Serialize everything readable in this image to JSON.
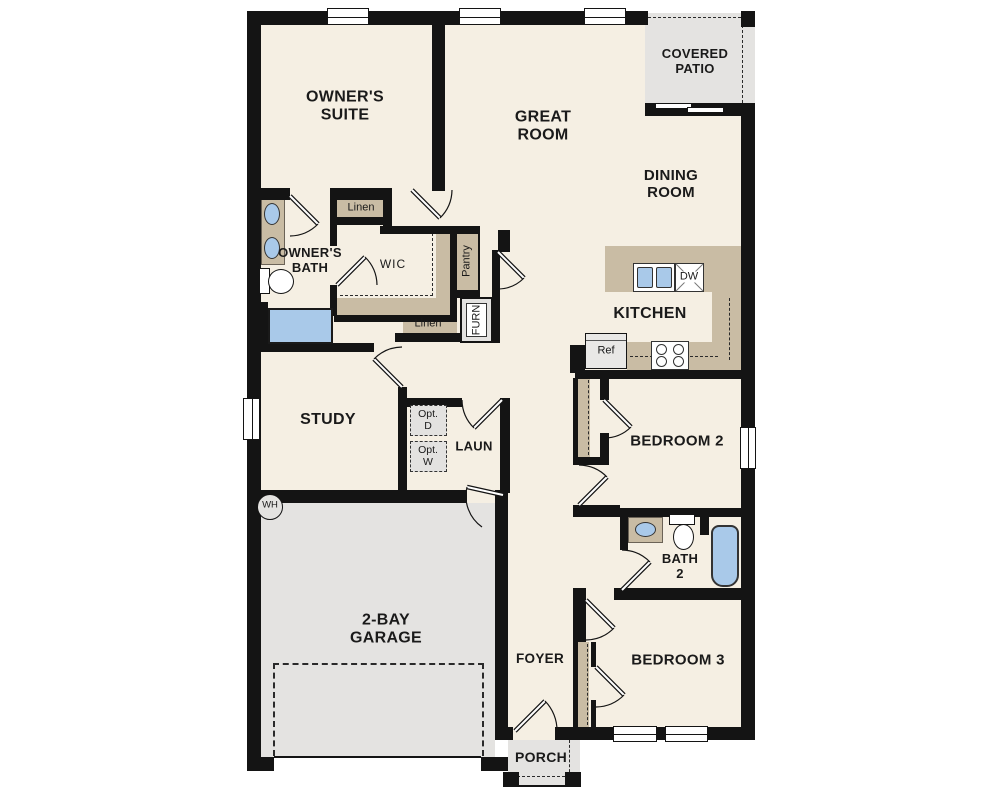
{
  "type": "residential-floor-plan",
  "colors": {
    "floor": "#f5efe3",
    "wall": "#141414",
    "casework_tan": "#c9bca4",
    "concrete_gray": "#e4e3e1",
    "fixture_blue": "#a9c9e9",
    "appliance_gray": "#e9e8e6"
  },
  "labels": {
    "owners_suite": "OWNER'S SUITE",
    "great_room": "GREAT ROOM",
    "covered_patio": "COVERED PATIO",
    "dining_room": "DINING ROOM",
    "owners_bath": "OWNER'S BATH",
    "wic": "WIC",
    "linen_top": "Linen",
    "linen_bottom": "Linen",
    "pantry": "Pantry",
    "furnace": "FURN",
    "kitchen": "KITCHEN",
    "refrigerator": "Ref",
    "dishwasher": "DW",
    "study": "STUDY",
    "laundry": "LAUN",
    "opt_dryer": "Opt. D",
    "opt_washer": "Opt. W",
    "water_heater": "WH",
    "bedroom2": "BEDROOM 2",
    "bath2": "BATH 2",
    "bedroom3": "BEDROOM 3",
    "foyer": "FOYER",
    "garage": "2-BAY GARAGE",
    "porch": "PORCH"
  }
}
